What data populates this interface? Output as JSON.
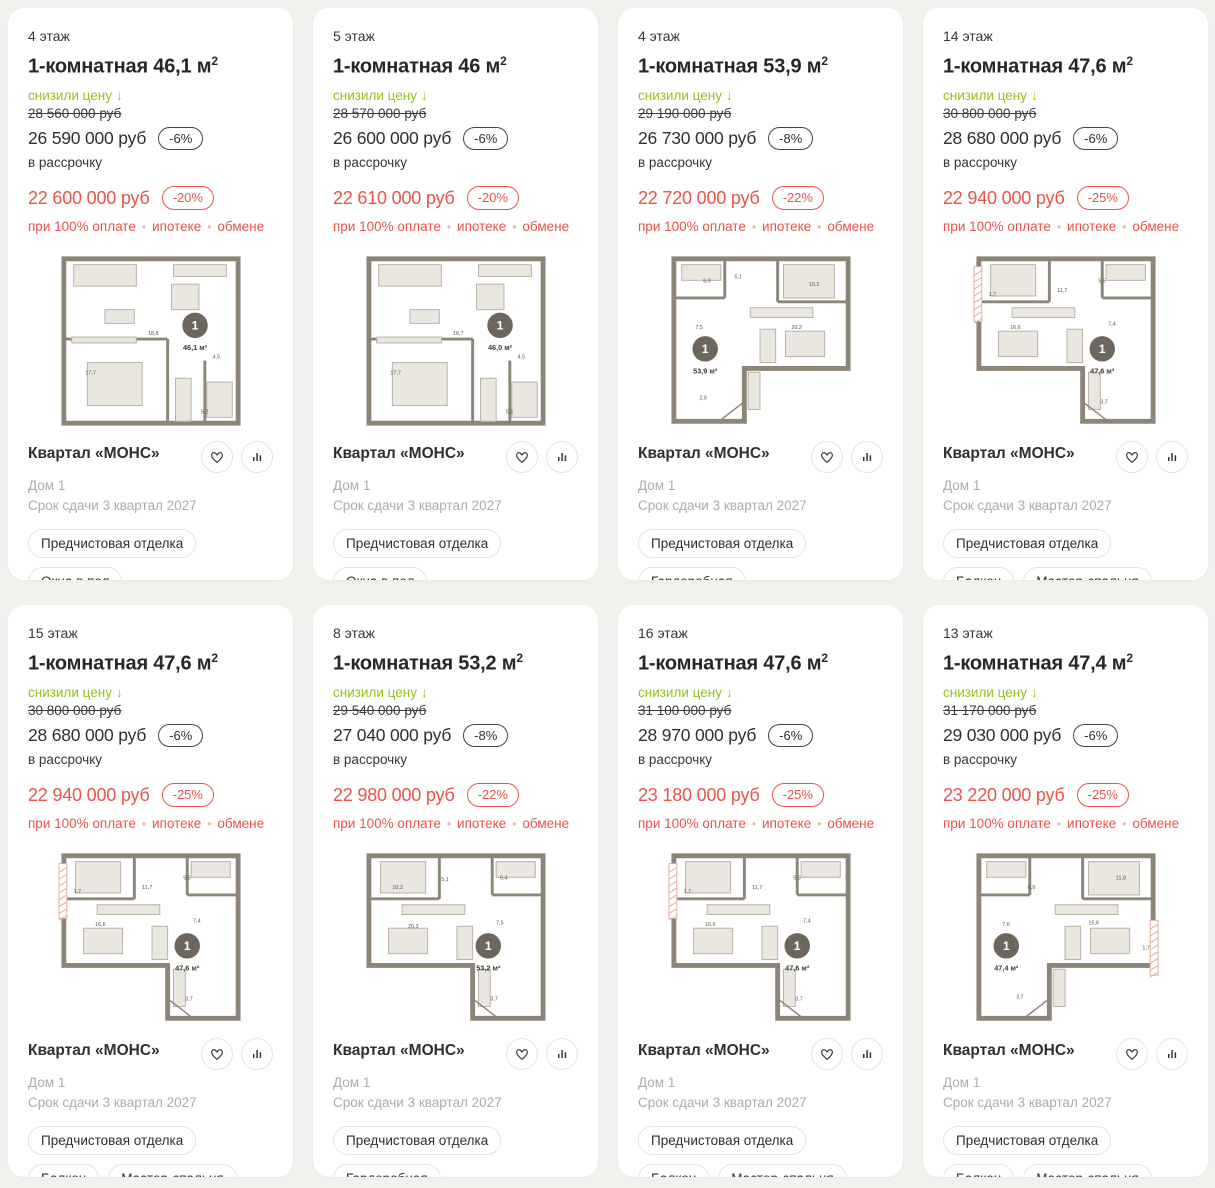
{
  "colors": {
    "accent_green": "#94c020",
    "accent_red": "#e9544a",
    "dark_text": "#2f3036",
    "muted_text": "#abacac",
    "page_bg": "#f2f1ee",
    "plan_wall": "#8d8678",
    "plan_balcony_hatch": "#e5ab9f"
  },
  "shared": {
    "sup2": "2",
    "arrow_down": "↓",
    "dot": "•",
    "price_reduced_label": "снизили цену",
    "installment_label": "в рассрочку",
    "conditions": [
      "при 100% оплате",
      "ипотеке",
      "обмене"
    ],
    "project": "Квартал «МОНС»",
    "house": "Дом 1",
    "deadline": "Срок сдачи 3 квартал 2027"
  },
  "cards": [
    {
      "floor": "4 этаж",
      "title": "1-комнатная 46,1 м",
      "old_price": "28 560 000 руб",
      "price": "26 590 000 руб",
      "discount": "-6%",
      "installment_price": "22 600 000 руб",
      "installment_discount": "-20%",
      "tags": [
        "Предчистовая отделка",
        "Окна в пол"
      ],
      "plan": {
        "variant": "rect",
        "hatch": "none",
        "unit": "1",
        "area": "46,1 м²",
        "unit_pos": [
          140,
          74
        ],
        "labels": [
          {
            "t": "18,8",
            "x": 92,
            "y": 84
          },
          {
            "t": "17,7",
            "x": 28,
            "y": 124
          },
          {
            "t": "4,5",
            "x": 158,
            "y": 108
          },
          {
            "t": "5,2",
            "x": 146,
            "y": 164
          }
        ]
      }
    },
    {
      "floor": "5 этаж",
      "title": "1-комнатная 46 м",
      "old_price": "28 570 000 руб",
      "price": "26 600 000 руб",
      "discount": "-6%",
      "installment_price": "22 610 000 руб",
      "installment_discount": "-20%",
      "tags": [
        "Предчистовая отделка",
        "Окна в пол"
      ],
      "plan": {
        "variant": "rect",
        "hatch": "none",
        "unit": "1",
        "area": "46,0 м²",
        "unit_pos": [
          140,
          74
        ],
        "labels": [
          {
            "t": "18,7",
            "x": 92,
            "y": 84
          },
          {
            "t": "17,7",
            "x": 28,
            "y": 124
          },
          {
            "t": "4,5",
            "x": 158,
            "y": 108
          },
          {
            "t": "5,1",
            "x": 146,
            "y": 164
          }
        ]
      }
    },
    {
      "floor": "4 этаж",
      "title": "1-комнатная 53,9 м",
      "old_price": "29 190 000 руб",
      "price": "26 730 000 руб",
      "discount": "-8%",
      "installment_price": "22 720 000 руб",
      "installment_discount": "-22%",
      "tags": [
        "Предчистовая отделка",
        "Гардеробная",
        "Мастер-спальня"
      ],
      "plan": {
        "variant": "l-left",
        "hatch": "none",
        "unit": "1",
        "area": "53,9 м²",
        "unit_pos": [
          38,
          98
        ],
        "labels": [
          {
            "t": "6,9",
            "x": 36,
            "y": 30
          },
          {
            "t": "5,1",
            "x": 68,
            "y": 26
          },
          {
            "t": "10,2",
            "x": 144,
            "y": 34
          },
          {
            "t": "7,5",
            "x": 28,
            "y": 78
          },
          {
            "t": "20,2",
            "x": 126,
            "y": 78
          },
          {
            "t": "2,9",
            "x": 32,
            "y": 150
          }
        ]
      }
    },
    {
      "floor": "14 этаж",
      "title": "1-комнатная 47,6 м",
      "old_price": "30 800 000 руб",
      "price": "28 680 000 руб",
      "discount": "-6%",
      "installment_price": "22 940 000 руб",
      "installment_discount": "-25%",
      "tags": [
        "Предчистовая отделка",
        "Балкон",
        "Мастер-спальня"
      ],
      "plan": {
        "variant": "l-right",
        "hatch": "left",
        "unit": "1",
        "area": "47,6 м²",
        "unit_pos": [
          132,
          98
        ],
        "labels": [
          {
            "t": "11,7",
            "x": 86,
            "y": 40
          },
          {
            "t": "9,5",
            "x": 128,
            "y": 30
          },
          {
            "t": "1,7",
            "x": 16,
            "y": 44
          },
          {
            "t": "16,6",
            "x": 38,
            "y": 78
          },
          {
            "t": "7,4",
            "x": 138,
            "y": 74
          },
          {
            "t": "3,7",
            "x": 130,
            "y": 154
          }
        ]
      }
    },
    {
      "floor": "15 этаж",
      "title": "1-комнатная 47,6 м",
      "old_price": "30 800 000 руб",
      "price": "28 680 000 руб",
      "discount": "-6%",
      "installment_price": "22 940 000 руб",
      "installment_discount": "-25%",
      "tags": [
        "Предчистовая отделка",
        "Балкон",
        "Мастер-спальня"
      ],
      "plan": {
        "variant": "l-right",
        "hatch": "left",
        "unit": "1",
        "area": "47,6 м²",
        "unit_pos": [
          132,
          98
        ],
        "labels": [
          {
            "t": "11,7",
            "x": 86,
            "y": 40
          },
          {
            "t": "9,6",
            "x": 128,
            "y": 30
          },
          {
            "t": "1,7",
            "x": 16,
            "y": 44
          },
          {
            "t": "16,6",
            "x": 38,
            "y": 78
          },
          {
            "t": "7,4",
            "x": 138,
            "y": 74
          },
          {
            "t": "3,7",
            "x": 130,
            "y": 154
          }
        ]
      }
    },
    {
      "floor": "8 этаж",
      "title": "1-комнатная 53,2 м",
      "old_price": "29 540 000 руб",
      "price": "27 040 000 руб",
      "discount": "-8%",
      "installment_price": "22 980 000 руб",
      "installment_discount": "-22%",
      "tags": [
        "Предчистовая отделка",
        "Гардеробная",
        "Мастер-спальня"
      ],
      "plan": {
        "variant": "l-right",
        "hatch": "none",
        "unit": "1",
        "area": "53,2 м²",
        "unit_pos": [
          128,
          98
        ],
        "labels": [
          {
            "t": "10,2",
            "x": 30,
            "y": 40
          },
          {
            "t": "5,1",
            "x": 80,
            "y": 32
          },
          {
            "t": "6,4",
            "x": 140,
            "y": 30
          },
          {
            "t": "20,3",
            "x": 46,
            "y": 80
          },
          {
            "t": "7,5",
            "x": 136,
            "y": 76
          },
          {
            "t": "3,7",
            "x": 130,
            "y": 154
          }
        ]
      }
    },
    {
      "floor": "16 этаж",
      "title": "1-комнатная 47,6 м",
      "old_price": "31 100 000 руб",
      "price": "28 970 000 руб",
      "discount": "-6%",
      "installment_price": "23 180 000 руб",
      "installment_discount": "-25%",
      "tags": [
        "Предчистовая отделка",
        "Балкон",
        "Мастер-спальня"
      ],
      "plan": {
        "variant": "l-right",
        "hatch": "left",
        "unit": "1",
        "area": "47,6 м²",
        "unit_pos": [
          132,
          98
        ],
        "labels": [
          {
            "t": "11,7",
            "x": 86,
            "y": 40
          },
          {
            "t": "9,5",
            "x": 128,
            "y": 30
          },
          {
            "t": "1,7",
            "x": 16,
            "y": 44
          },
          {
            "t": "16,6",
            "x": 38,
            "y": 78
          },
          {
            "t": "7,4",
            "x": 138,
            "y": 74
          },
          {
            "t": "3,7",
            "x": 130,
            "y": 154
          }
        ]
      }
    },
    {
      "floor": "13 этаж",
      "title": "1-комнатная 47,4 м",
      "old_price": "31 170 000 руб",
      "price": "29 030 000 руб",
      "discount": "-6%",
      "installment_price": "23 220 000 руб",
      "installment_discount": "-25%",
      "tags": [
        "Предчистовая отделка",
        "Балкон",
        "Мастер-спальня"
      ],
      "plan": {
        "variant": "l-left",
        "hatch": "right",
        "unit": "1",
        "area": "47,4 м²",
        "unit_pos": [
          34,
          98
        ],
        "labels": [
          {
            "t": "6,9",
            "x": 56,
            "y": 40
          },
          {
            "t": "11,8",
            "x": 146,
            "y": 30
          },
          {
            "t": "7,6",
            "x": 30,
            "y": 78
          },
          {
            "t": "15,6",
            "x": 118,
            "y": 76
          },
          {
            "t": "1,7",
            "x": 173,
            "y": 102
          },
          {
            "t": "3,7",
            "x": 44,
            "y": 152
          }
        ]
      }
    }
  ]
}
